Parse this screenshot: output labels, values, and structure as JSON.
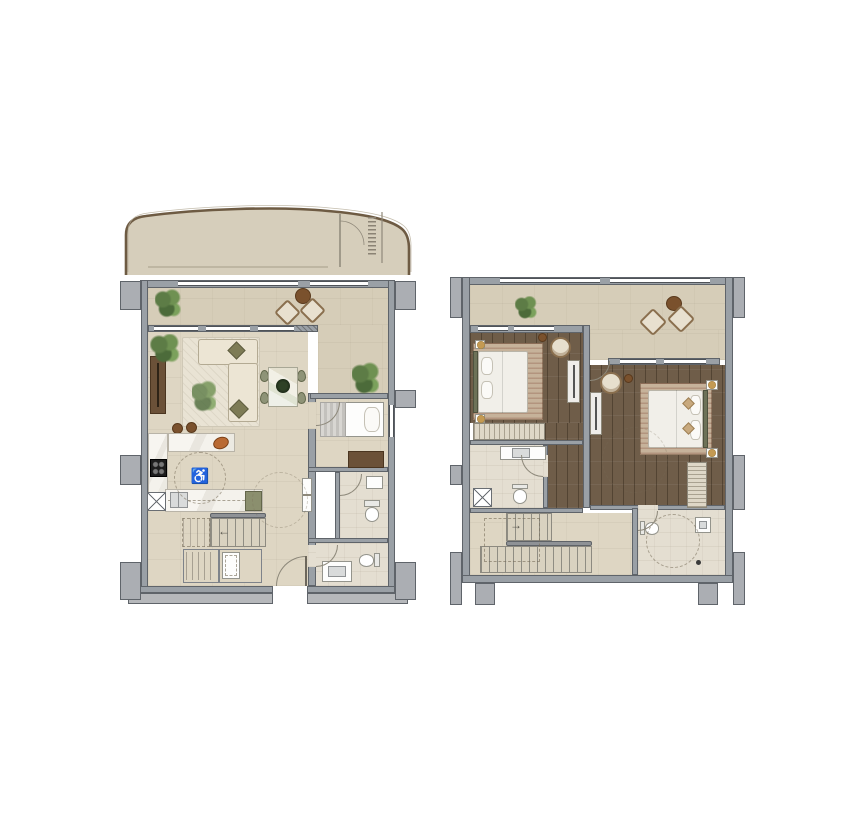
{
  "sheet": {
    "background": "#ffffff",
    "description": "Duplex apartment floor plans: lower level (left) with curved balcony terrace, living-dining room, open kitchen, guest bedroom, two bathrooms and stair; upper level (right) with terrace, two bedrooms, two bathrooms, wardrobes and stair"
  },
  "palette": {
    "wall": "#9aa0a6",
    "wallDark": "#5f646a",
    "wallLight": "#abaeb3",
    "band": "#b6b8bb",
    "floor": "#ded6c3",
    "floorDark": "#d6cdb8",
    "tile": "#e4ded1",
    "balcony": "#d6cebb",
    "balconyEdge": "#6e5b43",
    "wood": "#6f5d49",
    "rug": "#c6b29a",
    "rugLiving": "#e9e3d4",
    "cream": "#ece5d4",
    "creamLine": "#b3aa93",
    "marble": "#f6f4ef",
    "olive": "#7d7b55",
    "plant": "#5d7c46",
    "furnWood": "#6b5138",
    "brown": "#7a512d",
    "gold": "#c49a52",
    "headboard": "#6d7258",
    "steel": "#d9dbdb",
    "greenBoard": "#8b8f6e",
    "line": "#8d887a",
    "white": "#fdfdfc"
  },
  "symbols": {
    "accessibility": "♿",
    "stairUpLeft": "←",
    "stairUpRight": "→"
  },
  "plans": [
    {
      "id": "lower-level",
      "position": "left",
      "rooms": [
        "balcony",
        "terrace",
        "living-room",
        "dining-area",
        "kitchen",
        "bedroom",
        "bathroom",
        "shower-room",
        "hallway",
        "staircase",
        "storage"
      ],
      "furniture": [
        "corner-sofa",
        "area-rug",
        "tv-console",
        "dining-table-with-4-chairs",
        "kitchen-island",
        "bar-stools",
        "cooktop",
        "double-sink",
        "single-bed",
        "dresser",
        "toilets",
        "washbasins",
        "shower-tray",
        "washing-machine",
        "terrace-lounge-chairs",
        "terrace-side-table",
        "potted-plants"
      ],
      "annotations": [
        "wheelchair-accessibility-symbol",
        "turning-circle",
        "stair-direction-arrow"
      ]
    },
    {
      "id": "upper-level",
      "position": "right",
      "rooms": [
        "terrace",
        "bedroom-1",
        "bedroom-2",
        "bathroom-1",
        "bathroom-2",
        "hallway",
        "staircase",
        "wardrobe"
      ],
      "furniture": [
        "double-bed",
        "double-bed",
        "area-rugs",
        "armchairs",
        "side-tables",
        "tv-consoles",
        "wardrobe-units",
        "vanity-basin",
        "toilets",
        "washbasin",
        "terrace-lounge-chairs",
        "terrace-side-table",
        "potted-plant",
        "service-shaft"
      ],
      "annotations": [
        "turning-circle",
        "stair-direction-arrow"
      ]
    }
  ]
}
